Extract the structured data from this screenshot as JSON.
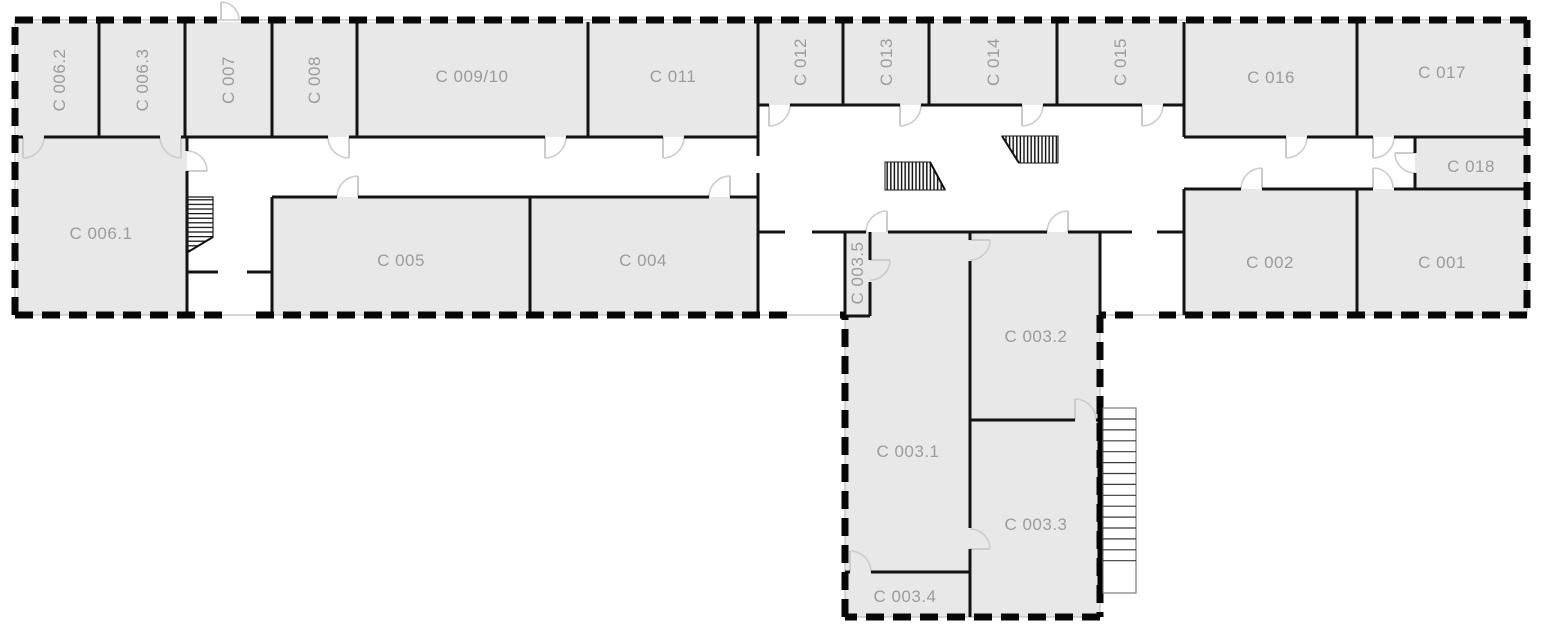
{
  "plan": {
    "width": 1551,
    "height": 634
  },
  "colors": {
    "background": "#ffffff",
    "room_fill": "#e8e8e8",
    "wall": "#131313",
    "exterior_wall": "#070707",
    "outline_underlay": "#c8c8c8",
    "label": "#9c9c9c",
    "door": "#cccccc",
    "stair_stroke": "#3a3a3a",
    "stair_frame": "#858585"
  },
  "rooms": [
    {
      "id": "c001",
      "label": "C 001"
    },
    {
      "id": "c002",
      "label": "C 002"
    },
    {
      "id": "c003-1",
      "label": "C 003.1"
    },
    {
      "id": "c003-2",
      "label": "C 003.2"
    },
    {
      "id": "c003-3",
      "label": "C 003.3"
    },
    {
      "id": "c003-4",
      "label": "C 003.4"
    },
    {
      "id": "c003-5",
      "label": "C 003.5"
    },
    {
      "id": "c004",
      "label": "C 004"
    },
    {
      "id": "c005",
      "label": "C 005"
    },
    {
      "id": "c006-1",
      "label": "C 006.1"
    },
    {
      "id": "c006-2",
      "label": "C 006.2"
    },
    {
      "id": "c006-3",
      "label": "C 006.3"
    },
    {
      "id": "c007",
      "label": "C 007"
    },
    {
      "id": "c008",
      "label": "C 008"
    },
    {
      "id": "c009-10",
      "label": "C 009/10"
    },
    {
      "id": "c011",
      "label": "C 011"
    },
    {
      "id": "c012",
      "label": "C 012"
    },
    {
      "id": "c013",
      "label": "C 013"
    },
    {
      "id": "c014",
      "label": "C 014"
    },
    {
      "id": "c015",
      "label": "C 015"
    },
    {
      "id": "c016",
      "label": "C 016"
    },
    {
      "id": "c017",
      "label": "C 017"
    },
    {
      "id": "c018",
      "label": "C 018"
    }
  ],
  "symbols": [
    {
      "name": "interior-stairs-symbol"
    },
    {
      "name": "hall-stairs-hatch-left"
    },
    {
      "name": "hall-stairs-hatch-right"
    },
    {
      "name": "exterior-stairs-symbol"
    }
  ]
}
